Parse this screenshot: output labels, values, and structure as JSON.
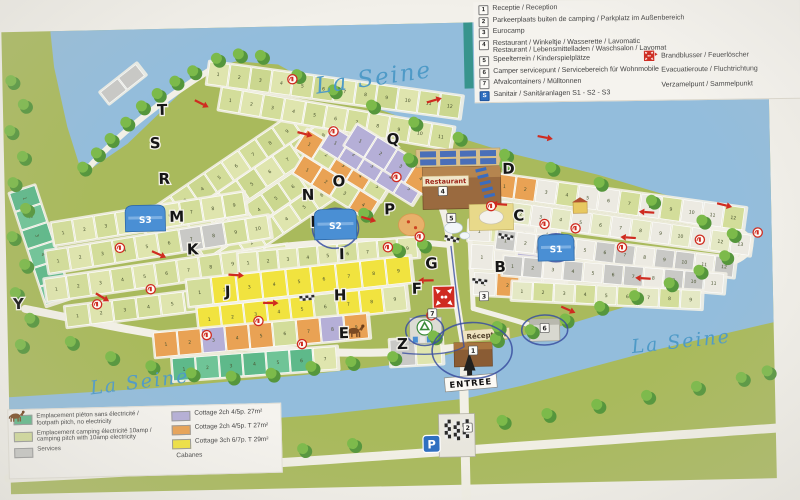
{
  "river": {
    "label": "La Seine"
  },
  "map": {
    "restaurant_label": "Restaurant",
    "reception_label": "Réception",
    "entrance_label": "ENTREE",
    "parking_letter": "P",
    "letters": [
      {
        "ch": "Y",
        "x": 12,
        "y": 301
      },
      {
        "ch": "T",
        "x": 160,
        "y": 110
      },
      {
        "ch": "S",
        "x": 152,
        "y": 143
      },
      {
        "ch": "R",
        "x": 160,
        "y": 179
      },
      {
        "ch": "M",
        "x": 170,
        "y": 217
      },
      {
        "ch": "K",
        "x": 187,
        "y": 250
      },
      {
        "ch": "N",
        "x": 303,
        "y": 198
      },
      {
        "ch": "O",
        "x": 334,
        "y": 185
      },
      {
        "ch": "Q",
        "x": 389,
        "y": 144
      },
      {
        "ch": "L",
        "x": 311,
        "y": 225
      },
      {
        "ch": "P",
        "x": 385,
        "y": 214
      },
      {
        "ch": "I",
        "x": 339,
        "y": 258
      },
      {
        "ch": "J",
        "x": 224,
        "y": 293
      },
      {
        "ch": "H",
        "x": 333,
        "y": 299
      },
      {
        "ch": "G",
        "x": 425,
        "y": 269
      },
      {
        "ch": "F",
        "x": 411,
        "y": 294
      },
      {
        "ch": "E",
        "x": 337,
        "y": 337
      },
      {
        "ch": "Z",
        "x": 395,
        "y": 349
      },
      {
        "ch": "B",
        "x": 494,
        "y": 274
      },
      {
        "ch": "C",
        "x": 514,
        "y": 223
      },
      {
        "ch": "D",
        "x": 504,
        "y": 176
      }
    ],
    "markers": [
      {
        "n": "1",
        "x": 471,
        "y": 352
      },
      {
        "n": "2",
        "x": 464,
        "y": 429
      },
      {
        "n": "3",
        "x": 483,
        "y": 298
      },
      {
        "n": "4",
        "x": 444,
        "y": 192
      },
      {
        "n": "5",
        "x": 452,
        "y": 219
      },
      {
        "n": "6",
        "x": 543,
        "y": 331
      },
      {
        "n": "7",
        "x": 431,
        "y": 314
      }
    ],
    "sanitair": [
      {
        "label": "S3",
        "x": 126,
        "y": 200,
        "w": 40,
        "h": 26
      },
      {
        "label": "S2",
        "x": 315,
        "y": 208,
        "w": 42,
        "h": 30
      },
      {
        "label": "S1",
        "x": 538,
        "y": 238,
        "w": 36,
        "h": 26
      }
    ],
    "strips": [
      {
        "name": "left-teal-column",
        "x": 36,
        "y": 178,
        "a": 73,
        "len": 118,
        "h": 26,
        "n": 6,
        "colors": [
          "#5eb98a",
          "#6fc497"
        ]
      },
      {
        "name": "nw-gate",
        "x": 104,
        "y": 86,
        "a": -37,
        "len": 46,
        "h": 14,
        "n": 2,
        "colors": [
          "#c9c9c6"
        ],
        "nums": false
      },
      {
        "name": "nw-fan-1",
        "x": 138,
        "y": 214,
        "a": -33,
        "len": 205,
        "h": 22,
        "n": 10,
        "colors": [
          "#d3dd9a",
          "#dfe5ae",
          "#d3dd9a",
          "#cbd78f"
        ]
      },
      {
        "name": "nw-fan-2",
        "x": 166,
        "y": 224,
        "a": -33,
        "len": 195,
        "h": 22,
        "n": 9,
        "colors": [
          "#d3dd9a",
          "#cbd78f",
          "#dfe5ae"
        ]
      },
      {
        "name": "nw-fan-3",
        "x": 194,
        "y": 236,
        "a": -33,
        "len": 185,
        "h": 22,
        "n": 9,
        "colors": [
          "#cbd78f",
          "#d3dd9a",
          "#dfe5ae",
          "#d3dd9a"
        ]
      },
      {
        "name": "nw-fan-4",
        "x": 220,
        "y": 248,
        "a": -33,
        "len": 170,
        "h": 20,
        "n": 8,
        "colors": [
          "#d3dd9a",
          "#dfe5ae"
        ]
      },
      {
        "name": "top-row-1",
        "x": 214,
        "y": 58,
        "a": 9,
        "len": 255,
        "h": 22,
        "n": 12,
        "colors": [
          "#dfe5ae",
          "#d3dd9a",
          "#cbd78f"
        ]
      },
      {
        "name": "top-row-2",
        "x": 226,
        "y": 84,
        "a": 11,
        "len": 235,
        "h": 22,
        "n": 11,
        "colors": [
          "#d3dd9a",
          "#dfe5ae"
        ]
      },
      {
        "name": "q-orange-1",
        "x": 310,
        "y": 128,
        "a": 33,
        "len": 100,
        "h": 22,
        "n": 5,
        "colors": [
          "#e9a254",
          "#d3dd9a",
          "#e9a254",
          "#e9a254",
          "#d3dd9a"
        ]
      },
      {
        "name": "q-lavender-1",
        "x": 336,
        "y": 126,
        "a": 33,
        "len": 108,
        "h": 24,
        "n": 5,
        "colors": [
          "#b5afd7"
        ]
      },
      {
        "name": "q-lavender-2",
        "x": 360,
        "y": 124,
        "a": 33,
        "len": 95,
        "h": 24,
        "n": 4,
        "colors": [
          "#b5afd7",
          "#b5afd7",
          "#b5afd7",
          "#e9a254"
        ]
      },
      {
        "name": "q-orange-2",
        "x": 306,
        "y": 154,
        "a": 33,
        "len": 88,
        "h": 20,
        "n": 4,
        "colors": [
          "#e9a254",
          "#e9a254",
          "#d3dd9a",
          "#e9a254"
        ]
      },
      {
        "name": "west-row-1",
        "x": 52,
        "y": 216,
        "a": -8,
        "len": 195,
        "h": 22,
        "n": 9,
        "colors": [
          "#d3dd9a",
          "#dfe5ae"
        ]
      },
      {
        "name": "west-row-2",
        "x": 46,
        "y": 244,
        "a": -8,
        "len": 225,
        "h": 22,
        "n": 10,
        "colors": [
          "#d3dd9a",
          "#dfe5ae",
          "#d3dd9a",
          "#d3dd9a",
          "#dfe5ae",
          "#d3dd9a",
          "#c9c9c6",
          "#c9c9c6",
          "#d3dd9a",
          "#dfe5ae"
        ]
      },
      {
        "name": "west-row-3",
        "x": 44,
        "y": 272,
        "a": -7,
        "len": 245,
        "h": 22,
        "n": 11,
        "colors": [
          "#dfe5ae",
          "#d3dd9a"
        ]
      },
      {
        "name": "west-row-4",
        "x": 64,
        "y": 300,
        "a": -6,
        "len": 215,
        "h": 20,
        "n": 9,
        "colors": [
          "#d3dd9a",
          "#dfe5ae",
          "#cbd78f"
        ]
      },
      {
        "name": "center-row-i",
        "x": 238,
        "y": 250,
        "a": -4,
        "len": 180,
        "h": 20,
        "n": 9,
        "colors": [
          "#dfe5ae",
          "#d3dd9a"
        ]
      },
      {
        "name": "yellow-row-1",
        "x": 186,
        "y": 276,
        "a": -5,
        "len": 225,
        "h": 26,
        "n": 9,
        "colors": [
          "#d3dd9a",
          "#f1e33f",
          "#f1e33f",
          "#f1e33f",
          "#f1e33f",
          "#f1e33f",
          "#f1e33f",
          "#f1e33f",
          "#f1e33f"
        ]
      },
      {
        "name": "yellow-row-2",
        "x": 196,
        "y": 304,
        "a": -5,
        "len": 210,
        "h": 24,
        "n": 9,
        "colors": [
          "#f1e33f",
          "#f1e33f",
          "#f1e33f",
          "#f1e33f",
          "#f1e33f",
          "#d3dd9a",
          "#f1e33f",
          "#f1e33f",
          "#dfe5ae"
        ]
      },
      {
        "name": "orange-row",
        "x": 152,
        "y": 328,
        "a": -4,
        "len": 215,
        "h": 24,
        "n": 9,
        "colors": [
          "#e9a254",
          "#e9a254",
          "#b5afd7",
          "#e9a254",
          "#e9a254",
          "#d3dd9a",
          "#e9a254",
          "#b5afd7",
          "#e9a254"
        ]
      },
      {
        "name": "teal-row",
        "x": 170,
        "y": 354,
        "a": -3,
        "len": 165,
        "h": 22,
        "n": 7,
        "colors": [
          "#5eb98a",
          "#6fc497",
          "#5eb98a",
          "#5eb98a",
          "#6fc497",
          "#5eb98a",
          "#dfe5ae"
        ]
      },
      {
        "name": "z-gray",
        "x": 388,
        "y": 340,
        "a": -2,
        "len": 52,
        "h": 26,
        "n": 2,
        "colors": [
          "#c9c9c6",
          "#dfe5ae"
        ],
        "nums": false
      },
      {
        "name": "b-row-1",
        "x": 470,
        "y": 222,
        "a": 4,
        "len": 90,
        "h": 20,
        "n": 4,
        "colors": [
          "#eceae2",
          "#dfe5ae",
          "#eceae2",
          "#eceae2"
        ]
      },
      {
        "name": "b-row-2",
        "x": 472,
        "y": 246,
        "a": 4,
        "len": 92,
        "h": 24,
        "n": 4,
        "colors": [
          "#eceae2",
          "#eceae2",
          "#b5afd7",
          "#eceae2"
        ]
      },
      {
        "name": "b-row-3",
        "x": 474,
        "y": 274,
        "a": 4,
        "len": 92,
        "h": 22,
        "n": 4,
        "colors": [
          "#eceae2",
          "#e9a254",
          "#eceae2",
          "#eceae2"
        ]
      },
      {
        "name": "wing-row-1",
        "x": 498,
        "y": 176,
        "a": 9,
        "len": 252,
        "h": 22,
        "n": 12,
        "colors": [
          "#e9a254",
          "#e9a254",
          "#eceae2",
          "#d3dd9a",
          "#eceae2",
          "#eceae2",
          "#d3dd9a",
          "#eceae2",
          "#d3dd9a",
          "#eceae2",
          "#eceae2",
          "#d3dd9a"
        ]
      },
      {
        "name": "wing-row-2",
        "x": 494,
        "y": 202,
        "a": 9,
        "len": 262,
        "h": 20,
        "n": 13,
        "colors": [
          "#eceae2",
          "#e4e8c4"
        ]
      },
      {
        "name": "wing-row-3",
        "x": 498,
        "y": 232,
        "a": 8,
        "len": 240,
        "h": 19,
        "n": 12,
        "colors": [
          "#c9c9c6",
          "#eceae2",
          "#c9c9c6",
          "#c9c9c6",
          "#eceae2",
          "#c9c9c6"
        ]
      },
      {
        "name": "wing-row-4",
        "x": 504,
        "y": 258,
        "a": 6,
        "len": 222,
        "h": 19,
        "n": 11,
        "colors": [
          "#c9c9c6",
          "#c9c9c6",
          "#eceae2",
          "#c9c9c6",
          "#eceae2",
          "#c9c9c6",
          "#c9c9c6",
          "#eceae2",
          "#c9c9c6",
          "#c9c9c6",
          "#eceae2"
        ]
      },
      {
        "name": "wing-row-5",
        "x": 512,
        "y": 284,
        "a": 4,
        "len": 190,
        "h": 18,
        "n": 9,
        "colors": [
          "#e4e8c4",
          "#d3dd9a"
        ]
      }
    ]
  },
  "legend_top": {
    "items": [
      {
        "num": "1",
        "text": "Receptie / Reception"
      },
      {
        "num": "2",
        "text": "Parkeerplaats buiten de camping / Parkplatz im Außenbereich"
      },
      {
        "num": "3",
        "text": "Eurocamp"
      },
      {
        "num": "4",
        "text": "Restaurant / Winkeltje / Wasserette / Lavomatic",
        "text2": "Restaurant / Lebensmittelladen / Waschsalon / Lavomat"
      },
      {
        "num": "5",
        "text": "Speelterrein / Kinderspielplätze"
      },
      {
        "num": "6",
        "text": "Camper servicepunt / Servicebereich für Wohnmobile"
      },
      {
        "num": "7",
        "text": "Afvalcontainers / Mülltonnen"
      },
      {
        "num": "S",
        "text": "Sanitair / Sanitäranlagen S1 - S2 - S3",
        "blue": true
      }
    ],
    "symbols": [
      {
        "icon": "fire-extinguisher",
        "text": "Brandblusser / Feuerlöscher"
      },
      {
        "icon": "evacuation-arrow",
        "text": "Evacuatieroute / Fluchtrichtung"
      },
      {
        "icon": "assembly-point",
        "text": "Verzamelpunt / Sammelpunkt"
      }
    ]
  },
  "legend_bottom": {
    "pitch_items": [
      {
        "color": "#5eb98a",
        "lines": [
          "Emplacement piéton sans électricité /",
          "footpath pitch, no electricity"
        ]
      },
      {
        "color": "#d3dd9a",
        "lines": [
          "Emplacement camping électricité 10amp /",
          "camping pitch with 10amp electricity"
        ]
      },
      {
        "color": "#c9c9c6",
        "lines": [
          "Services"
        ]
      }
    ],
    "cottage_items": [
      {
        "color": "#b5afd7",
        "text": "Cottage 2ch 4/5p. 27m²"
      },
      {
        "color": "#e9a254",
        "text": "Cottage 2ch 4/5p. T 27m²"
      },
      {
        "color": "#f1e33f",
        "text": "Cottage 3ch 6/7p. T 29m²"
      }
    ],
    "cabanes": "Cabanes"
  },
  "colors": {
    "water": "#93bddc",
    "land": "#a9ba5c",
    "road": "#f2f0e6",
    "red": "#cf2b20",
    "route_blue": "#3a4fa0",
    "sanitair_blue": "#4a8fd4",
    "pitch_green": "#d3dd9a",
    "teal_pitch": "#5eb98a",
    "cottage_lavender": "#b5afd7",
    "cottage_orange": "#e9a254",
    "cottage_yellow": "#f1e33f",
    "services_gray": "#c9c9c6"
  }
}
